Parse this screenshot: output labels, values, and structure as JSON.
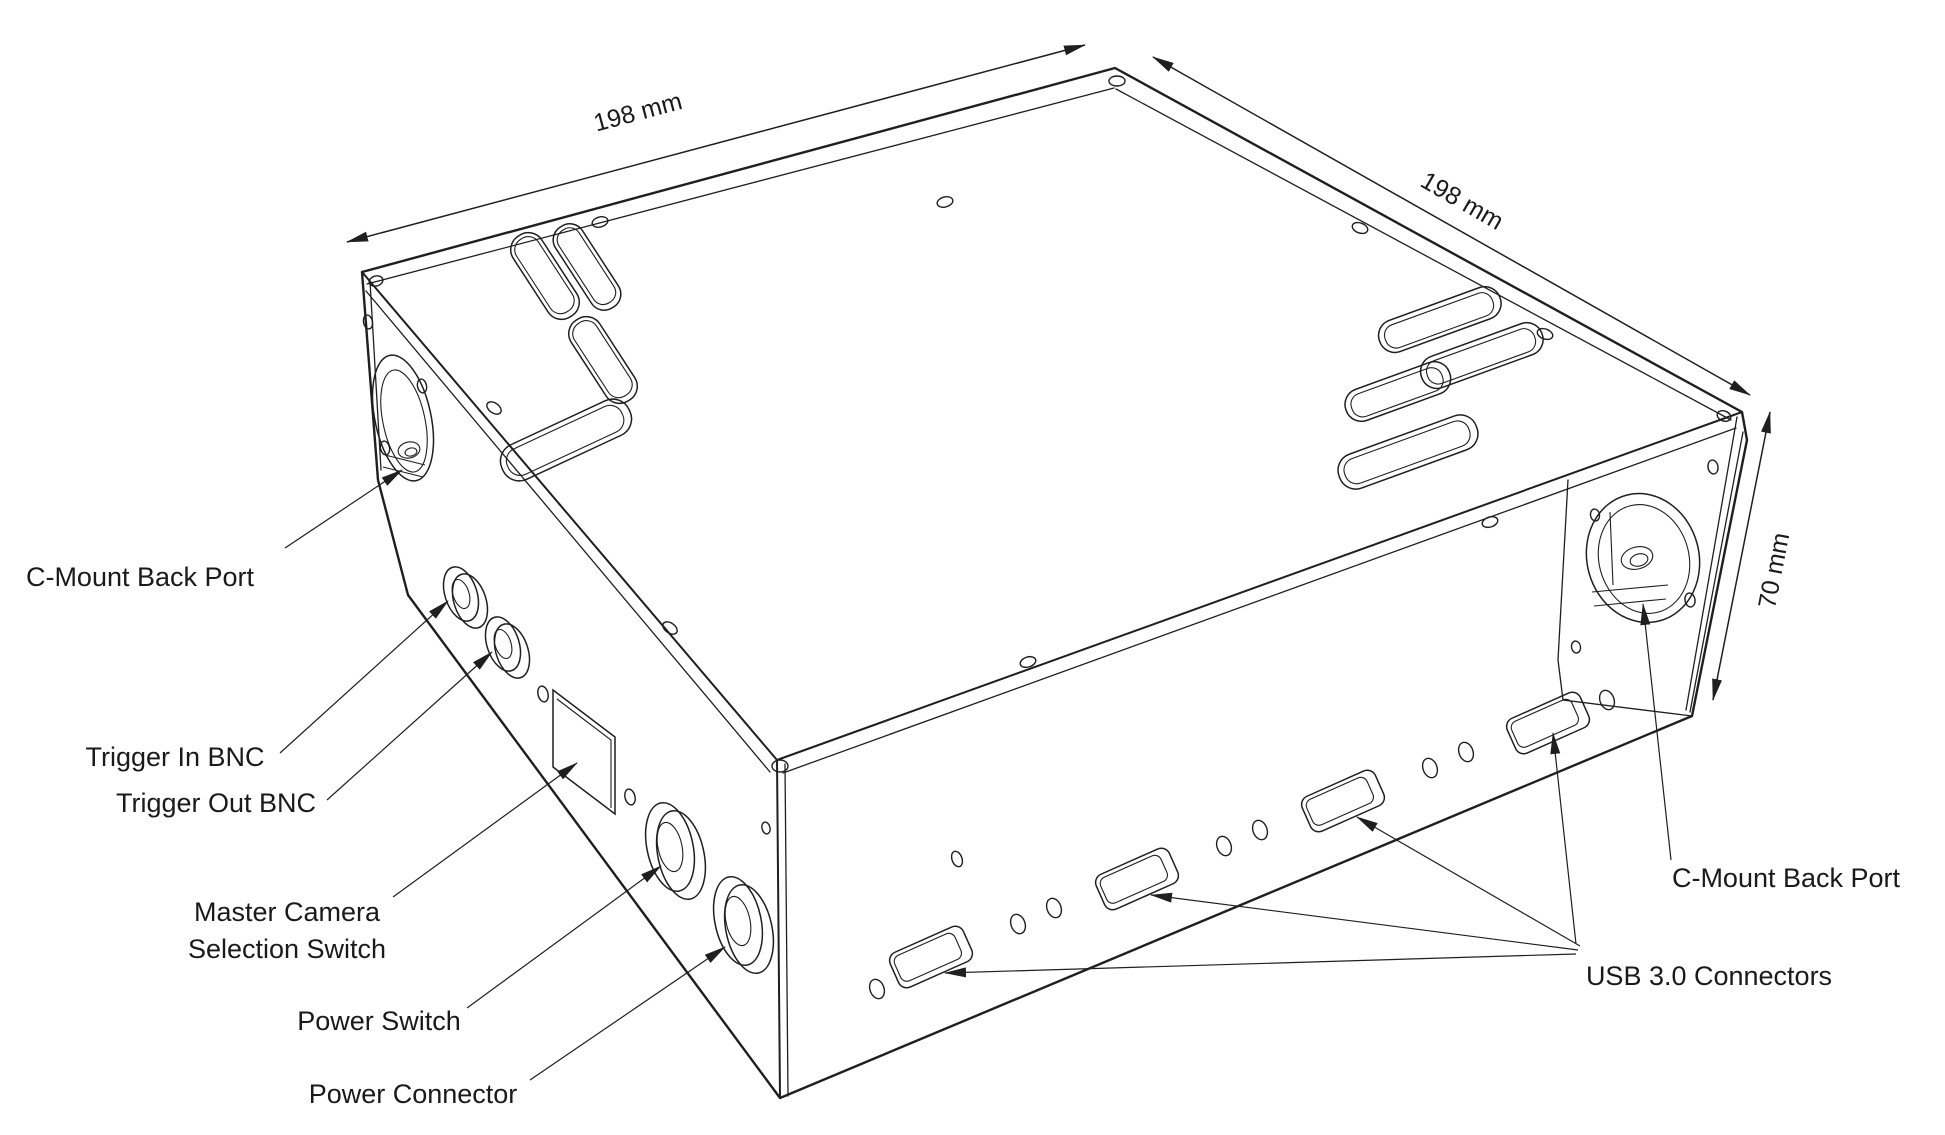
{
  "figure": {
    "kind": "isometric technical line drawing",
    "subject": "camera enclosure with ports"
  },
  "dimensions": {
    "top_left_edge": "198 mm",
    "top_right_edge": "198 mm",
    "height_edge": "70 mm"
  },
  "labels": {
    "cmount_left": "C-Mount Back Port",
    "trigger_in": "Trigger In BNC",
    "trigger_out": "Trigger Out BNC",
    "master_camera_line1": "Master Camera",
    "master_camera_line2": "Selection Switch",
    "power_switch": "Power Switch",
    "power_connector": "Power Connector",
    "usb": "USB 3.0 Connectors",
    "cmount_right": "C-Mount Back Port"
  },
  "colors": {
    "line": "#1f1f1f",
    "text": "#1a1a1a",
    "background": "#ffffff"
  }
}
